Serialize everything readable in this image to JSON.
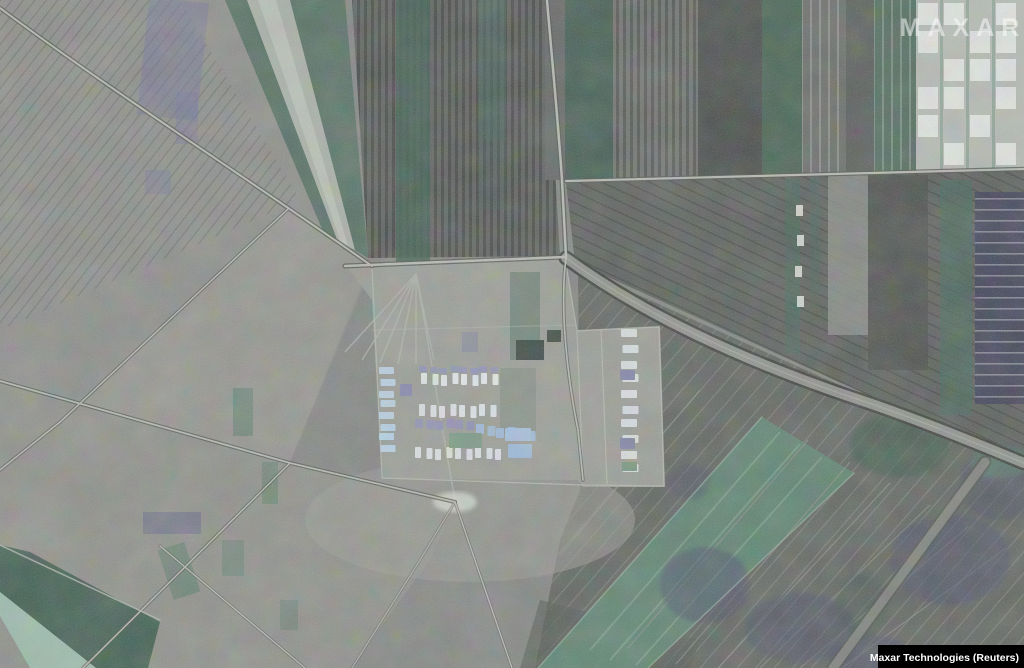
{
  "image": {
    "watermark": "MAXAR",
    "credit": "Maxar Technologies (Reuters)",
    "subject": "Satellite view of farmland with a central vehicle staging compound and roads"
  },
  "colors": {
    "base_gray": "#838683",
    "field_dark": "#5b5f5c",
    "field_green": "#466456",
    "band_light_green": "#5c8471",
    "mint": "#9fc4b2",
    "purple_tint": "#73769a",
    "vehicle_white": "#e3e9ec",
    "vehicle_blue": "#a8c4dc",
    "road_light": "#b6bab2",
    "road_casing": "#474b47",
    "credit_bar_bg": "#000000",
    "credit_text": "#ffffff",
    "watermark_color": "#ffffff"
  },
  "scene": {
    "vehicle_rows": [
      {
        "name": "west-column",
        "x": 379,
        "y": 367,
        "dx": 0,
        "dy": 11,
        "n": 8,
        "w": 15,
        "h": 7,
        "color": "#b9d2e4"
      },
      {
        "name": "row-1-lavender",
        "x": 419,
        "y": 366,
        "dx": 10,
        "dy": 0,
        "n": 8,
        "w": 8,
        "h": 6,
        "color": "#9093b6"
      },
      {
        "name": "row-1-white",
        "x": 421,
        "y": 373,
        "dx": 10,
        "dy": 0,
        "n": 8,
        "w": 6,
        "h": 11,
        "color": "#e3e9ec"
      },
      {
        "name": "row-2-white",
        "x": 419,
        "y": 404,
        "dx": 10,
        "dy": 0,
        "n": 8,
        "w": 6,
        "h": 12,
        "color": "#dde3e6"
      },
      {
        "name": "row-3-lavender",
        "x": 415,
        "y": 419,
        "dx": 10,
        "dy": 0,
        "n": 6,
        "w": 8,
        "h": 9,
        "color": "#8f92b4"
      },
      {
        "name": "row-3-blue",
        "x": 476,
        "y": 424,
        "dx": 10,
        "dy": 1,
        "n": 6,
        "w": 8,
        "h": 10,
        "color": "#9db9d8"
      },
      {
        "name": "row-4-white",
        "x": 415,
        "y": 447,
        "dx": 10,
        "dy": 0,
        "n": 9,
        "w": 6,
        "h": 11,
        "color": "#dce2e4"
      },
      {
        "name": "east-column",
        "x": 621,
        "y": 329,
        "dx": 0,
        "dy": 15,
        "n": 10,
        "w": 16,
        "h": 8,
        "color": "#d9e0e2"
      }
    ],
    "vehicle_accents": [
      {
        "x": 620,
        "y": 370,
        "w": 15,
        "h": 10,
        "color": "#7e81a8"
      },
      {
        "x": 620,
        "y": 438,
        "w": 15,
        "h": 11,
        "color": "#8285aa"
      },
      {
        "x": 622,
        "y": 462,
        "w": 15,
        "h": 9,
        "color": "#74967f"
      },
      {
        "x": 505,
        "y": 428,
        "w": 26,
        "h": 13,
        "color": "#a3c0de"
      },
      {
        "x": 449,
        "y": 433,
        "w": 33,
        "h": 15,
        "color": "#7a9a86"
      },
      {
        "x": 508,
        "y": 444,
        "w": 24,
        "h": 14,
        "color": "#9db9d8"
      },
      {
        "x": 400,
        "y": 384,
        "w": 12,
        "h": 12,
        "color": "#8588ac"
      }
    ]
  }
}
